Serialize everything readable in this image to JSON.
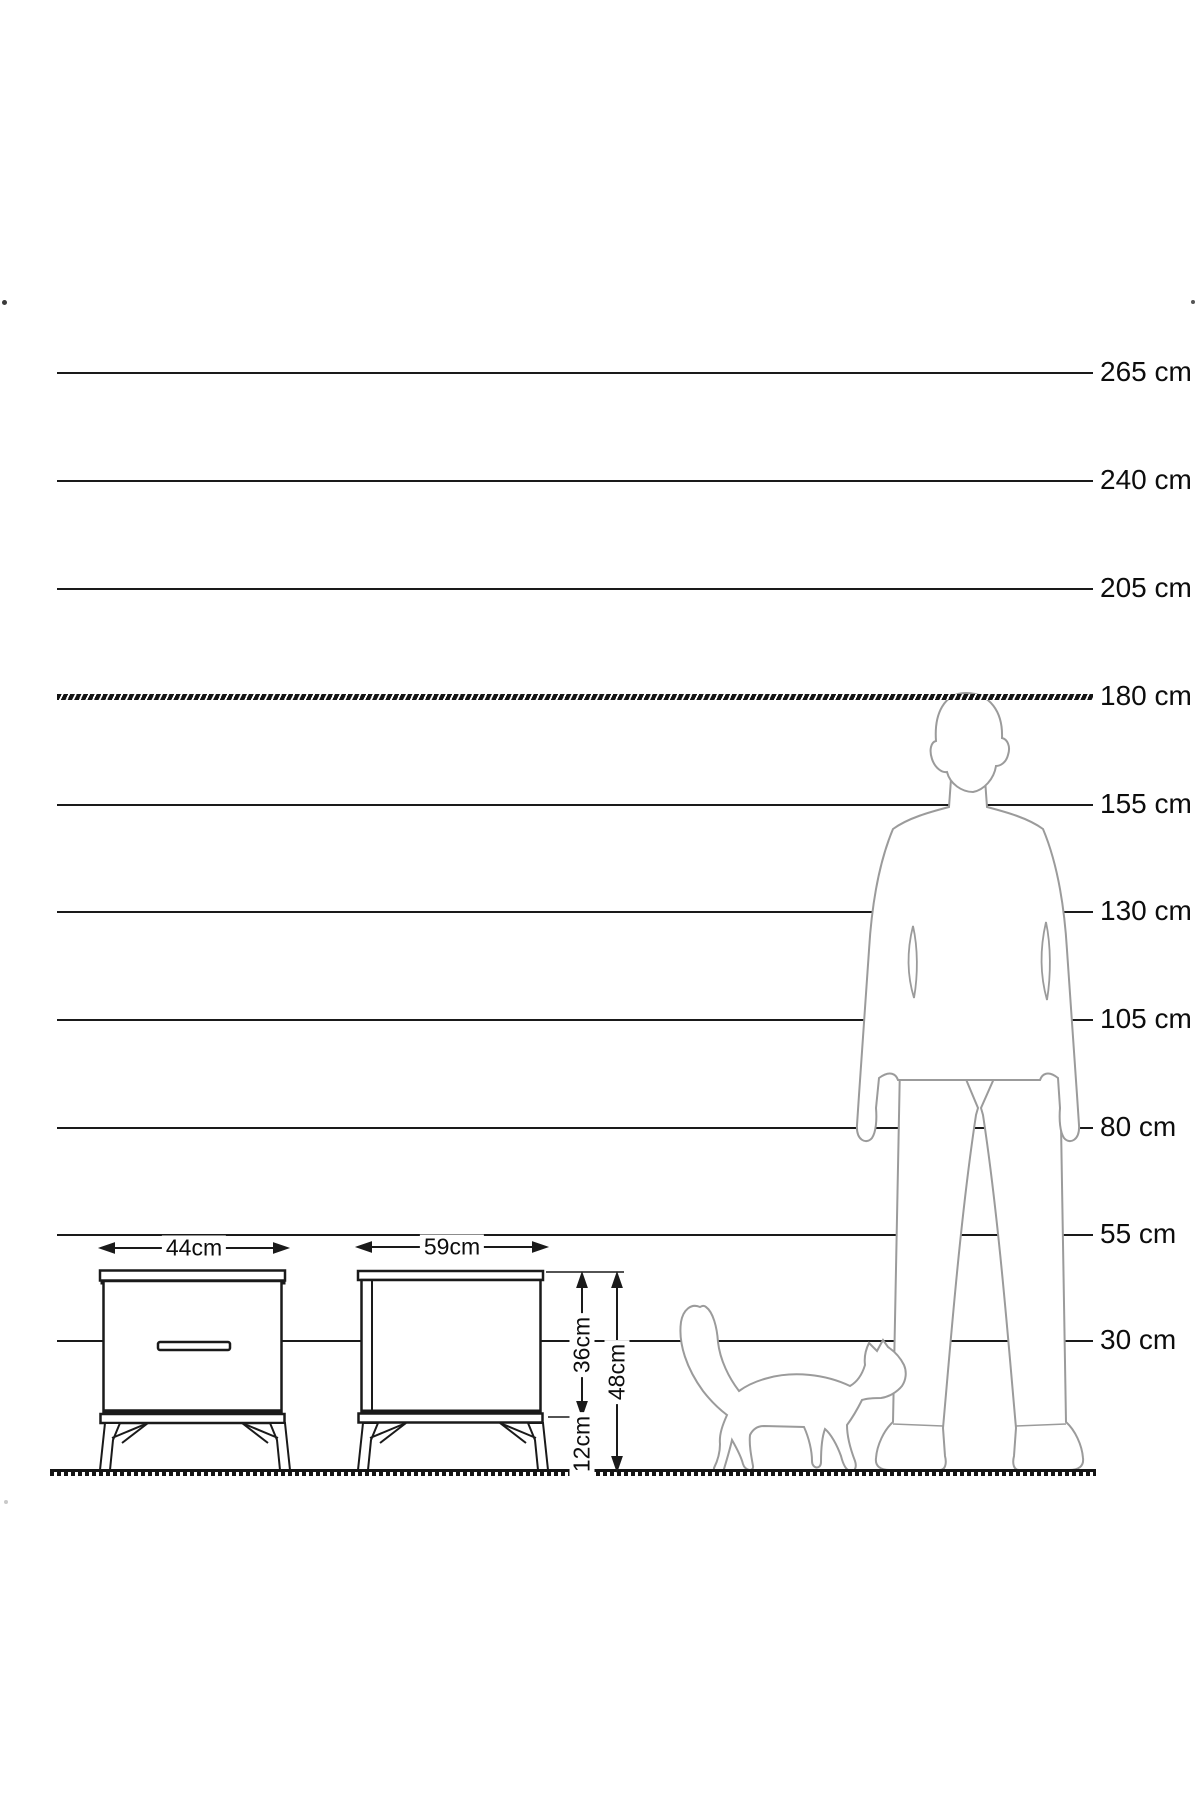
{
  "scale": {
    "unit": "cm",
    "lines": [
      {
        "label": "265 cm",
        "value": 265
      },
      {
        "label": "240 cm",
        "value": 240
      },
      {
        "label": "205 cm",
        "value": 205
      },
      {
        "label": "180 cm",
        "value": 180
      },
      {
        "label": "155 cm",
        "value": 155
      },
      {
        "label": "130 cm",
        "value": 130
      },
      {
        "label": "105 cm",
        "value": 105
      },
      {
        "label": "80 cm",
        "value": 80
      },
      {
        "label": "55 cm",
        "value": 55
      },
      {
        "label": "30 cm",
        "value": 30
      }
    ],
    "emphasized_line": "180 cm"
  },
  "dimensions": {
    "front_width": "44cm",
    "side_width": "59cm",
    "body_height": "36cm",
    "leg_height": "12cm",
    "total_height": "48cm"
  },
  "colors": {
    "line": "#1a1a1a",
    "silhouette_stroke": "#9b9b9b",
    "background": "#ffffff"
  }
}
